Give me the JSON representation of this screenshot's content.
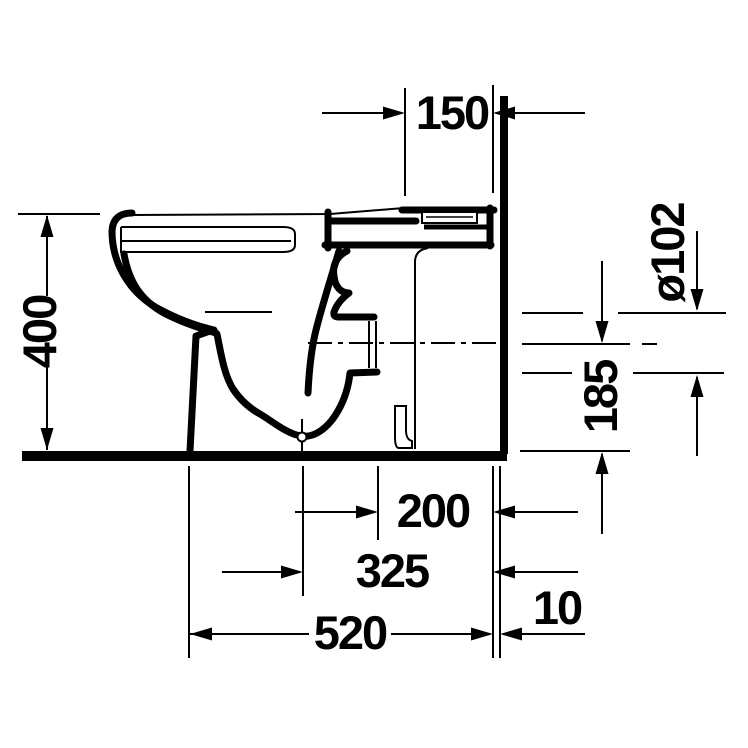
{
  "canvas": {
    "background": "#ffffff",
    "line_color": "#000000"
  },
  "drawing": {
    "subject": "toilet-side-elevation-technical-drawing",
    "units": "mm",
    "dimensions": {
      "top_depth": "150",
      "height": "400",
      "outlet_diameter": "ø102",
      "outlet_center_height": "185",
      "rear_depth": "200",
      "mid_depth": "325",
      "total_depth": "520",
      "wall_gap": "10"
    }
  }
}
